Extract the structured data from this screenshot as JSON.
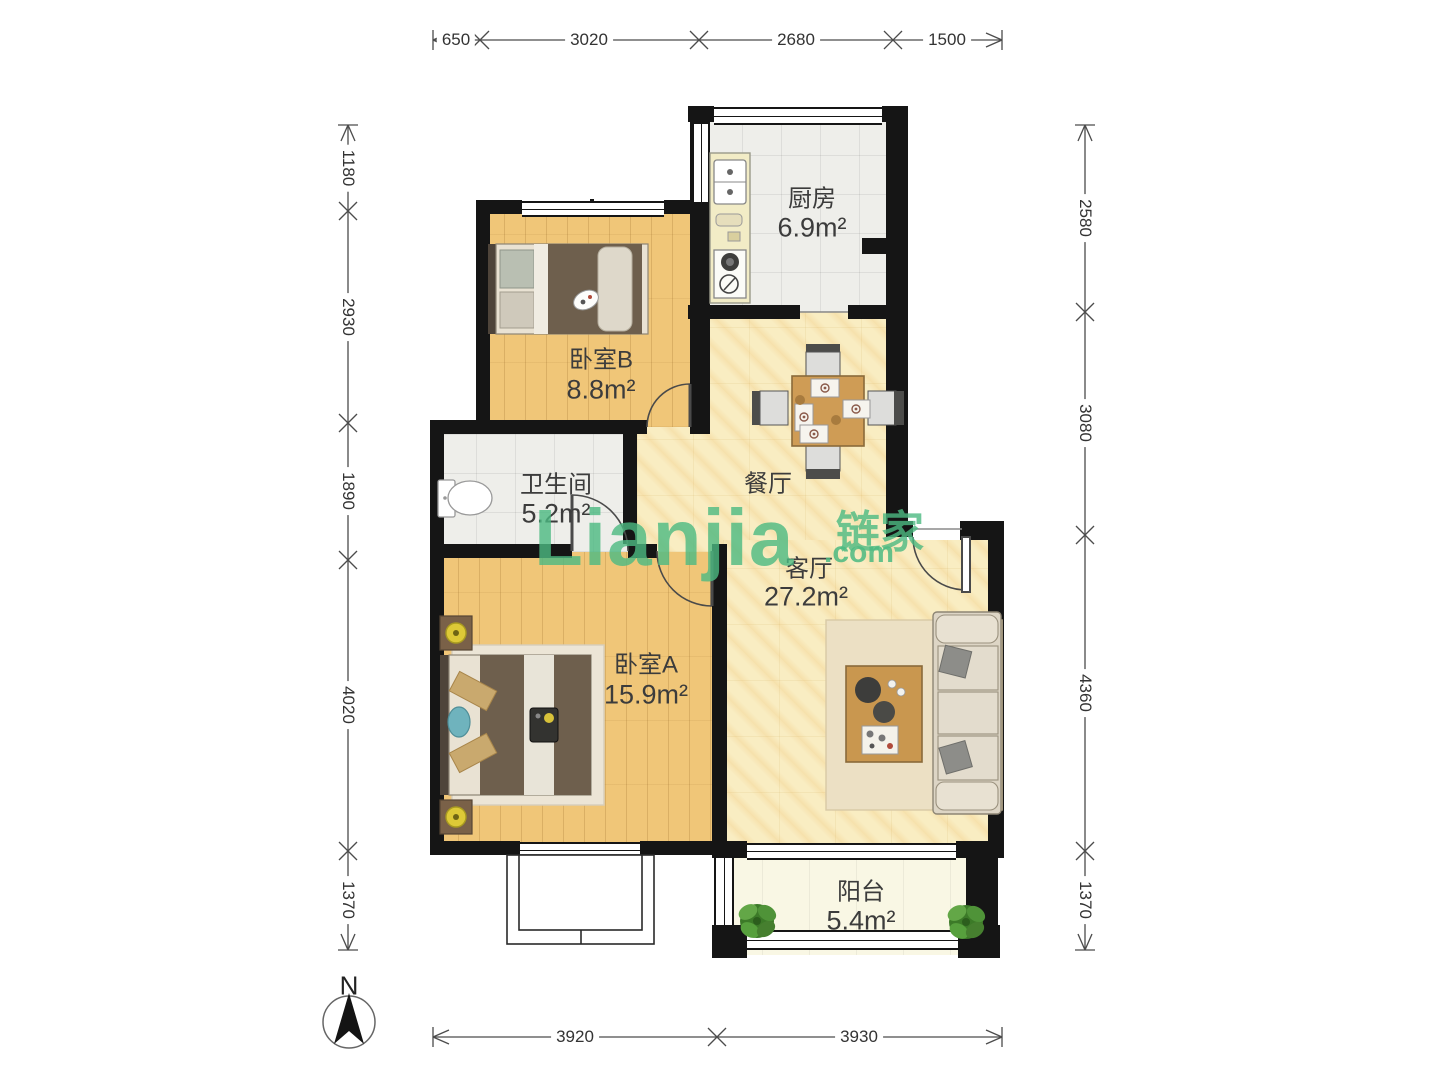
{
  "watermark": {
    "main": "Lianjia",
    "cn": "链家",
    "com": ".com",
    "color": "#4cba82"
  },
  "compass": {
    "label": "N"
  },
  "rooms": {
    "kitchen": {
      "name": "厨房",
      "area": "6.9m²"
    },
    "bedroomB": {
      "name": "卧室B",
      "area": "8.8m²"
    },
    "bathroom": {
      "name": "卫生间",
      "area": "5.2m²"
    },
    "dining": {
      "name": "餐厅"
    },
    "living": {
      "name": "客厅",
      "area": "27.2m²"
    },
    "bedroomA": {
      "name": "卧室A",
      "area": "15.9m²"
    },
    "balcony": {
      "name": "阳台",
      "area": "5.4m²"
    }
  },
  "dims": {
    "top": [
      "650",
      "3020",
      "2680",
      "1500"
    ],
    "left": [
      "1180",
      "2930",
      "1890",
      "4020",
      "1370"
    ],
    "right": [
      "2580",
      "3080",
      "4360",
      "1370"
    ],
    "bottom": [
      "3920",
      "3930"
    ]
  },
  "colors": {
    "wall": "#151515",
    "wood_floor": "#f0c678",
    "tile_floor": "#eeeeea",
    "marble_floor": "#f9edc2",
    "balcony_floor": "#f9f7e4",
    "watermark_green": "#4cba82"
  }
}
